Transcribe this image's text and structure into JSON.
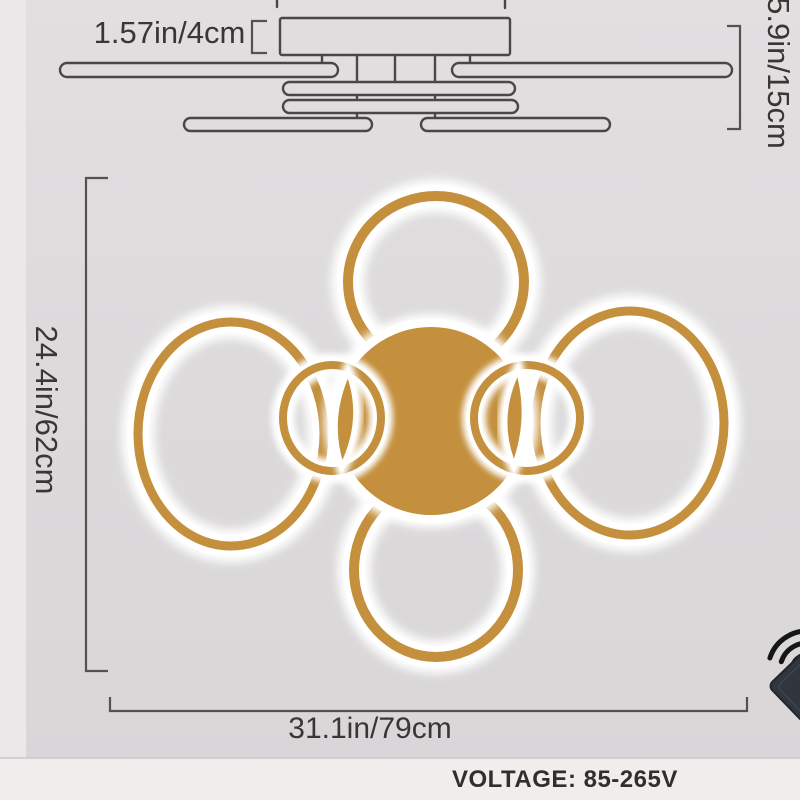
{
  "product_diagram": {
    "type": "ceiling-lamp-dimension-diagram",
    "annotations": {
      "canopy_width_label": "1.57in/4cm",
      "height_label": "5.9in/15cm",
      "depth_label": "24.4in/62cm",
      "width_label": "31.1in/79cm"
    },
    "voltage": {
      "label": "VOLTAGE: 85-265V"
    },
    "lamp": {
      "large_rings": 4,
      "small_rings": 2,
      "gold_color": "#c4903e",
      "glow_color": "#ffffff"
    },
    "colors": {
      "background": "#dcdadb",
      "bottom_strip": "#f0eeed",
      "line": "#4b4745",
      "text": "#3b3633",
      "remote_body": "#31353d"
    },
    "icons": {
      "wifi": "wifi-signal-icon",
      "remote": "remote-control"
    }
  }
}
